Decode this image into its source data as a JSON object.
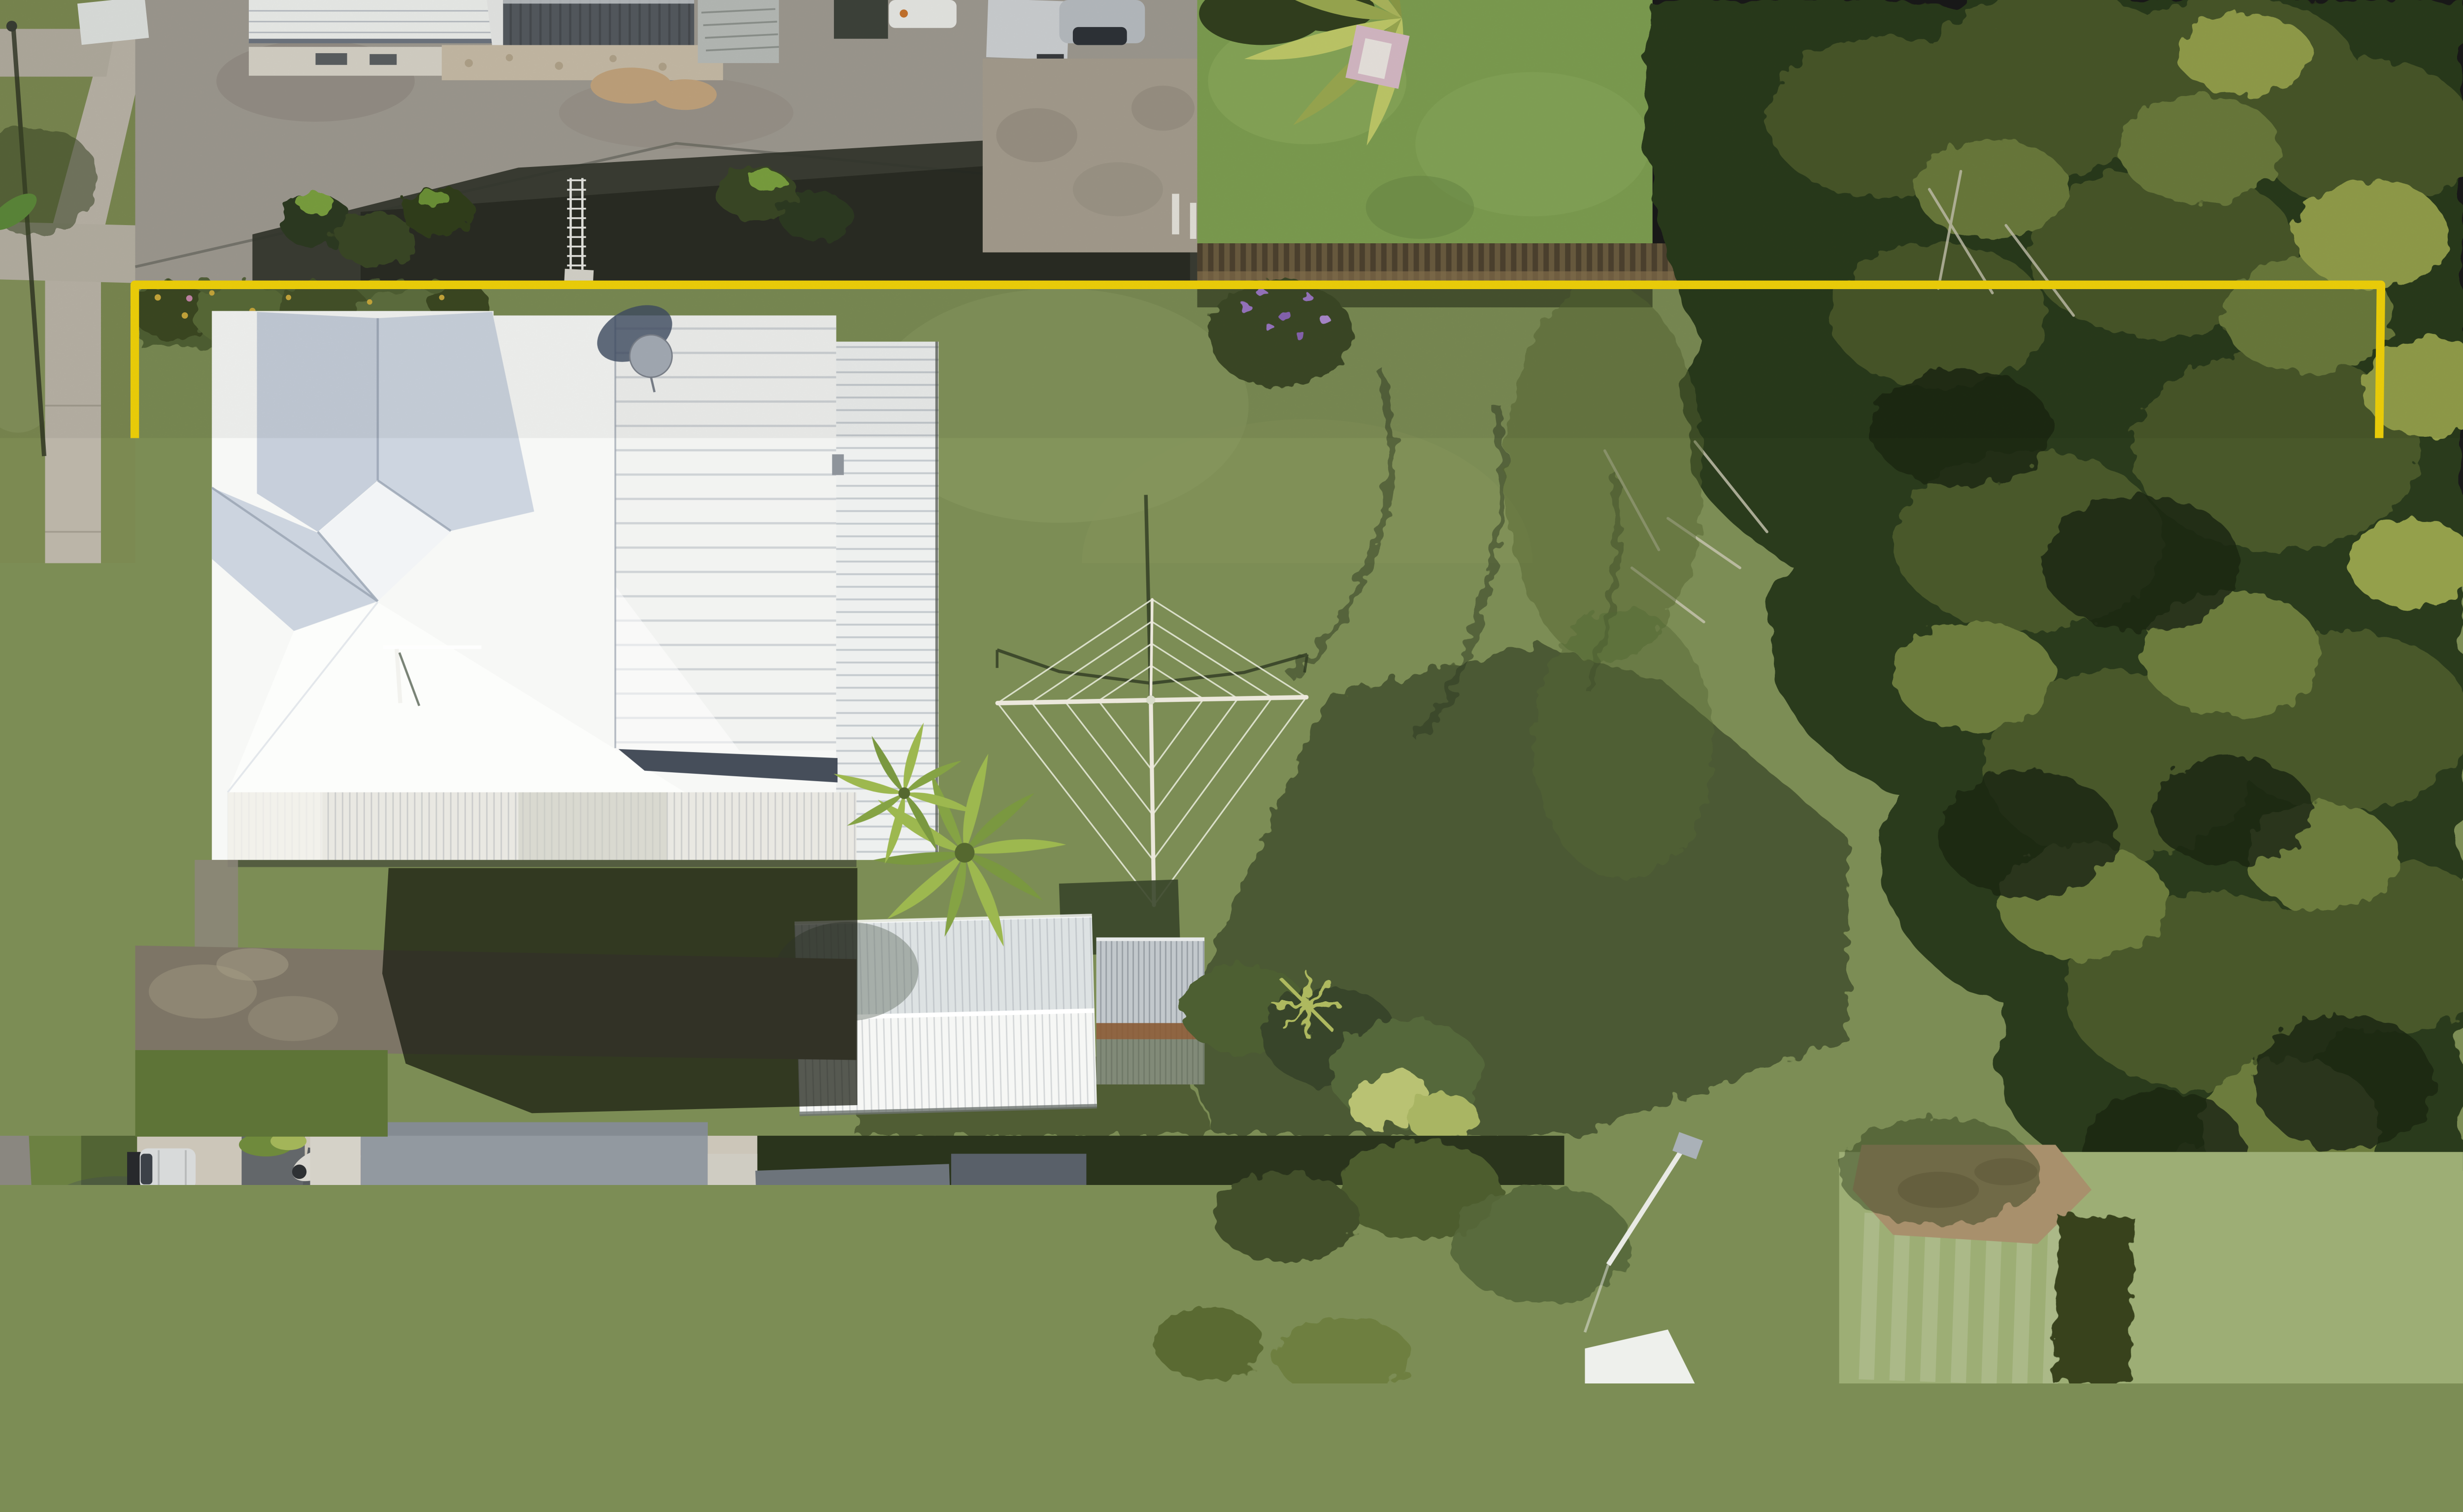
{
  "scene": {
    "type": "aerial-drone-photograph",
    "subject": "residential property with large lawn outlined by a yellow site-boundary overlay",
    "annotation": {
      "kind": "property-boundary-outline",
      "shape": "rectangle-with-jogged-corners",
      "color": "#F5D60A"
    },
    "visible_objects": [
      "main-house-white-metal-roof",
      "satellite-dish",
      "rotary-clothesline",
      "garden-shed",
      "small-shed",
      "tree-fern",
      "backyard-lawn",
      "dense-tree-canopy-right",
      "street-footpath",
      "neighbour-houses",
      "timber-picket-fence",
      "garage-roller-door",
      "skylights",
      "silver-car",
      "red-wheelie-bin",
      "concrete-driveway",
      "palm-shadow"
    ]
  },
  "colors": {
    "boundary": "#F5D60A",
    "grassYard": "#7C8D55",
    "grassBright": "#7FA052",
    "grassMown": "#9DAE75",
    "roofWhite": "#F7F8F6",
    "roofShaded": "#C7CFDB",
    "roofGray": "#9299A0",
    "canopyDark": "#2C3A1E",
    "canopyMid": "#49592C",
    "canopyLight": "#6C7C3E",
    "canopyYellow": "#94A04C",
    "asphalt": "#A09B92",
    "asphaltShadow": "#33362C",
    "paving": "#7D7566",
    "concrete": "#CCC6B9",
    "concreteShadow": "#414A56",
    "fenceBrown": "#4E4330",
    "shedRoof": "#E7EAEA",
    "rust": "#8A5A33",
    "fern": "#9DB84F",
    "dish": "#A7AEB8",
    "carSilver": "#D8DADA",
    "binRed": "#CE3A28",
    "pebbles": "#DED9CF",
    "footpath": "#BBB5A8"
  }
}
